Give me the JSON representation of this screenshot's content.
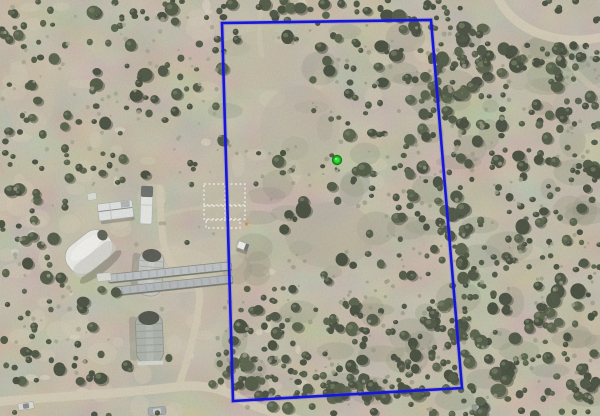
{
  "scene": {
    "kind": "aerial-parcel-map",
    "description": "Aerial drone photo of a rural scrubland property with a blue parcel boundary overlay and a green location marker; farm buildings and dirt roads at left",
    "width": 600,
    "height": 416
  },
  "palette": {
    "base": "#b5ab97",
    "dirt_light": "#cfc6b0",
    "dirt_bright": "#ded6c2",
    "scrub_gray": "#82846e",
    "speck_olive": "#8d8f78",
    "speck_tan": "#97987f",
    "tree_shadow": "#20251a",
    "tree_highlight": "#5d684a",
    "road": "#d2c8b2",
    "trail": "#c9b88f"
  },
  "vegetation": {
    "tree_palette": [
      "#2d3626",
      "#37422c",
      "#404c33",
      "#2a3322",
      "#333d2a"
    ],
    "regions": [
      {
        "name": "left-far",
        "x": 0,
        "y": 0,
        "w": 70,
        "h": 416,
        "count": 95
      },
      {
        "name": "left-mid",
        "x": 70,
        "y": 0,
        "w": 150,
        "h": 416,
        "count": 115
      },
      {
        "name": "top-strip",
        "x": 90,
        "y": 0,
        "w": 370,
        "h": 22,
        "count": 42
      },
      {
        "name": "inside-parcel",
        "x": 215,
        "y": 15,
        "w": 250,
        "h": 385,
        "count": 215
      },
      {
        "name": "inside-right",
        "x": 400,
        "y": 20,
        "w": 65,
        "h": 380,
        "count": 85
      },
      {
        "name": "east-dense",
        "x": 460,
        "y": 0,
        "w": 140,
        "h": 416,
        "count": 265
      },
      {
        "name": "top-right",
        "x": 430,
        "y": 0,
        "w": 170,
        "h": 90,
        "count": 62
      },
      {
        "name": "bottom-band",
        "x": 0,
        "y": 358,
        "w": 600,
        "h": 58,
        "count": 95
      },
      {
        "name": "bottom-inside",
        "x": 230,
        "y": 300,
        "w": 230,
        "h": 100,
        "count": 80
      }
    ],
    "clearings": [
      [
        115,
        210,
        48,
        26
      ],
      [
        92,
        252,
        38,
        30
      ],
      [
        150,
        273,
        24,
        30
      ],
      [
        149,
        338,
        24,
        34
      ],
      [
        172,
        278,
        70,
        20
      ],
      [
        226,
        205,
        30,
        27
      ],
      [
        265,
        95,
        48,
        58
      ],
      [
        252,
        250,
        30,
        38
      ],
      [
        120,
        397,
        135,
        16
      ],
      [
        197,
        340,
        20,
        62
      ],
      [
        545,
        28,
        58,
        16
      ],
      [
        332,
        228,
        34,
        26
      ],
      [
        163,
        180,
        14,
        30
      ],
      [
        500,
        12,
        40,
        18
      ],
      [
        40,
        400,
        60,
        12
      ]
    ],
    "specks_inside": {
      "x": 215,
      "y": 20,
      "w": 385,
      "h": 390,
      "count": 320,
      "color": "#8d8f78"
    },
    "specks_left": {
      "x": 0,
      "y": 0,
      "w": 215,
      "h": 416,
      "count": 130,
      "color": "#97987f"
    }
  },
  "terrain": {
    "light_patches": {
      "count": 70,
      "color": "#cfc6b0",
      "opacity": 0.5
    },
    "bright_patches": {
      "count": 25,
      "color": "#ded6c2",
      "opacity": 0.6
    },
    "gray_blotches": {
      "x": 220,
      "y": 30,
      "w": 380,
      "h": 370,
      "count": 80,
      "color": "#82846e",
      "opacity": 0.28
    },
    "soft_shapes": [
      {
        "name": "yard-clearing",
        "e": [
          175,
          270,
          42,
          23
        ],
        "fill": "#cdc3ad",
        "opacity": 0.55
      },
      {
        "name": "yard-clearing-2",
        "e": [
          215,
          255,
          30,
          18
        ],
        "fill": "#c9bfa9",
        "opacity": 0.45
      },
      {
        "name": "yard-clearing-3",
        "e": [
          150,
          300,
          30,
          15
        ],
        "fill": "#c9bfa9",
        "opacity": 0.4
      },
      {
        "name": "open-upper-inside",
        "e": [
          262,
          60,
          36,
          30
        ],
        "fill": "#bdb49f",
        "opacity": 0.6
      },
      {
        "name": "open-mid-inside",
        "e": [
          300,
          130,
          40,
          45
        ],
        "fill": "#b4ad9b",
        "opacity": 0.5
      },
      {
        "name": "gray-open-center",
        "e": [
          330,
          235,
          45,
          33
        ],
        "fill": "#a8a393",
        "opacity": 0.5
      },
      {
        "name": "rocky-top-right",
        "e": [
          583,
          108,
          30,
          26
        ],
        "fill": "#b3ada0",
        "opacity": 0.7
      },
      {
        "name": "rocky-top-right-2",
        "e": [
          520,
          80,
          14,
          10
        ],
        "fill": "#a9a495",
        "opacity": 0.5
      },
      {
        "name": "open-left-edge",
        "e": [
          30,
          95,
          25,
          40
        ],
        "fill": "#c3b9a4",
        "opacity": 0.5
      },
      {
        "name": "grid-soil",
        "e": [
          226,
          205,
          26,
          24
        ],
        "fill": "#c2b9a6",
        "opacity": 0.5
      }
    ]
  },
  "roads": [
    {
      "name": "main-entrance-road",
      "d": "M -5,402 C 60,396 120,394 175,387 C 205,383 225,390 240,399 C 258,409 280,414 300,420",
      "stroke": "#d2c8b2",
      "width": 9,
      "opacity": 0.95
    },
    {
      "name": "driveway-north",
      "d": "M 178,388 C 188,360 196,330 199,305 C 202,288 196,280 185,275 C 172,270 165,255 163,240 C 161,222 160,203 160,188",
      "stroke": "#d0c6b0",
      "width": 7,
      "opacity": 0.9
    },
    {
      "name": "path-to-garden",
      "d": "M 165,215 C 180,210 195,208 212,206",
      "stroke": "#cdc3ae",
      "width": 4,
      "opacity": 0.5
    },
    {
      "name": "top-right-road",
      "d": "M 497,-5 C 505,15 525,32 555,38 C 575,42 590,40 606,36",
      "stroke": "#d4cab4",
      "width": 9,
      "opacity": 0.9
    },
    {
      "name": "top-right-spur",
      "d": "M 555,38 C 565,60 580,80 600,92",
      "stroke": "#ccc2ac",
      "width": 6,
      "opacity": 0.6
    },
    {
      "name": "top-center-path",
      "d": "M 262,-2 C 259,18 258,36 262,55",
      "stroke": "#cdc3ae",
      "width": 5,
      "opacity": 0.5
    },
    {
      "name": "fence-line-trail",
      "d": "M 245,396 C 310,392 400,388 458,386",
      "stroke": "#c9b88f",
      "width": 2.5,
      "opacity": 0.55
    }
  ],
  "structures": [
    {
      "name": "dome-barn",
      "cx": 89,
      "cy": 252,
      "rot": -38,
      "parts": [
        {
          "t": "ellipse",
          "g": [
            0,
            19,
            26,
            6
          ],
          "fill": "#3e3d33",
          "op": 0.35
        },
        {
          "t": "rect",
          "g": [
            -25,
            -16.5,
            50,
            33,
            15
          ],
          "fill": "#eeeeec",
          "stroke": "#a3a39d",
          "sw": 0.8
        },
        {
          "t": "rect",
          "g": [
            -25,
            2,
            50,
            14,
            7
          ],
          "fill": "#c9c9c3",
          "op": 0.7
        },
        {
          "t": "ellipse",
          "g": [
            0,
            -5,
            19,
            7
          ],
          "fill": "#f8f8f6",
          "op": 0.8
        },
        {
          "t": "ellipse",
          "g": [
            21,
            -5,
            5,
            5.5
          ],
          "fill": "#45483f",
          "op": 1
        }
      ]
    },
    {
      "name": "mobile-home",
      "cx": 115.5,
      "cy": 210.5,
      "rot": -7,
      "parts": [
        {
          "t": "rect",
          "g": [
            -16,
            4,
            34,
            8,
            2
          ],
          "fill": "#3e3d33",
          "op": 0.35
        },
        {
          "t": "rect",
          "g": [
            -17.5,
            -8.5,
            35,
            17,
            1
          ],
          "fill": "#e3e5e4",
          "stroke": "#9fa2a3",
          "sw": 0.7
        },
        {
          "t": "line",
          "g": [
            -17,
            -1,
            17,
            -1
          ],
          "stroke": "#787d7f",
          "sw": 1
        },
        {
          "t": "rect",
          "g": [
            6,
            -8,
            9,
            6,
            0
          ],
          "fill": "#9aa0a2",
          "op": 0.8
        },
        {
          "t": "line",
          "g": [
            -5,
            -8.5,
            -5,
            8.5
          ],
          "stroke": "#b8bbba",
          "sw": 0.8
        }
      ]
    },
    {
      "name": "rv-trailer",
      "cx": 146.5,
      "cy": 205,
      "rot": 2,
      "parts": [
        {
          "t": "rect",
          "g": [
            -6,
            -19,
            12,
            38,
            2
          ],
          "fill": "#e9eae8",
          "stroke": "#a9aba8",
          "sw": 0.7
        },
        {
          "t": "rect",
          "g": [
            -6,
            -19,
            12,
            11,
            2
          ],
          "fill": "#565a58",
          "op": 1
        },
        {
          "t": "line",
          "g": [
            -6,
            0,
            6,
            0
          ],
          "stroke": "#c2c4c1",
          "sw": 0.8
        }
      ]
    },
    {
      "name": "small-shed",
      "cx": 92,
      "cy": 196.5,
      "rot": -10,
      "parts": [
        {
          "t": "rect",
          "g": [
            -4.5,
            -3.5,
            9,
            7,
            0.5
          ],
          "fill": "#dcdcd6",
          "stroke": "#a9a9a3",
          "sw": 0.6
        }
      ]
    },
    {
      "name": "quonset-hut-silver",
      "cx": 150.5,
      "cy": 273,
      "rot": 4,
      "parts": [
        {
          "t": "rect",
          "g": [
            -19,
            -19,
            8,
            40,
            3
          ],
          "fill": "#514f44",
          "op": 0.3
        },
        {
          "t": "rect",
          "g": [
            -12.5,
            -23,
            25,
            46,
            11
          ],
          "fill": "#c0c3bf",
          "stroke": "#8f928e",
          "sw": 0.8
        },
        {
          "t": "rect",
          "g": [
            -3,
            -21,
            6,
            42,
            3
          ],
          "fill": "#d4d7d3",
          "op": 0.5
        },
        {
          "t": "line",
          "g": [
            -12,
            -12,
            12,
            -12
          ],
          "stroke": "#a6a9a5",
          "sw": 1
        },
        {
          "t": "line",
          "g": [
            -12,
            -6,
            12,
            -6
          ],
          "stroke": "#a6a9a5",
          "sw": 1
        },
        {
          "t": "line",
          "g": [
            -12,
            0,
            12,
            0
          ],
          "stroke": "#a6a9a5",
          "sw": 1
        },
        {
          "t": "line",
          "g": [
            -12,
            6,
            12,
            6
          ],
          "stroke": "#a6a9a5",
          "sw": 1
        },
        {
          "t": "line",
          "g": [
            -12,
            12,
            12,
            12
          ],
          "stroke": "#a6a9a5",
          "sw": 1
        },
        {
          "t": "ellipse",
          "g": [
            0,
            -17.5,
            9.5,
            6.5
          ],
          "fill": "#3f413c",
          "op": 1
        }
      ]
    },
    {
      "name": "quonset-hut-metal",
      "cx": 149.5,
      "cy": 338,
      "rot": -2,
      "parts": [
        {
          "t": "rect",
          "g": [
            -20,
            -22,
            8,
            44,
            3
          ],
          "fill": "#514f44",
          "op": 0.25
        },
        {
          "t": "rect",
          "g": [
            -13.5,
            -26,
            27,
            52,
            12
          ],
          "fill": "#a4aaa3",
          "stroke": "#7e847d",
          "sw": 0.8
        },
        {
          "t": "rect",
          "g": [
            -3.5,
            -23,
            7,
            47,
            3
          ],
          "fill": "#b6bcb5",
          "op": 0.6
        },
        {
          "t": "line",
          "g": [
            -13,
            -14,
            13,
            -14
          ],
          "stroke": "#8f958e",
          "sw": 1
        },
        {
          "t": "line",
          "g": [
            -13,
            -7,
            13,
            -7
          ],
          "stroke": "#8f958e",
          "sw": 1
        },
        {
          "t": "line",
          "g": [
            -13,
            0,
            13,
            0
          ],
          "stroke": "#8f958e",
          "sw": 1
        },
        {
          "t": "line",
          "g": [
            -13,
            7,
            13,
            7
          ],
          "stroke": "#8f958e",
          "sw": 1
        },
        {
          "t": "line",
          "g": [
            -13,
            14,
            13,
            14
          ],
          "stroke": "#8f958e",
          "sw": 1
        },
        {
          "t": "ellipse",
          "g": [
            0,
            -20,
            10.5,
            7
          ],
          "fill": "#363a31",
          "op": 1
        },
        {
          "t": "rect",
          "g": [
            -13,
            23,
            26,
            4,
            1
          ],
          "fill": "#d3d6d0",
          "op": 1
        }
      ]
    },
    {
      "name": "greenhouse-row-1",
      "cx": 170,
      "cy": 272.5,
      "rot": -6,
      "parts": [
        {
          "t": "rect",
          "g": [
            -62,
            -4.5,
            124,
            9,
            3
          ],
          "fill": "#b9bec3",
          "stroke": "#72766d",
          "sw": 0.7
        },
        {
          "t": "line",
          "g": [
            -62,
            3.8,
            62,
            3.8
          ],
          "stroke": "#5f6359",
          "sw": 1.2
        },
        {
          "t": "line",
          "g": [
            -62,
            0,
            62,
            0
          ],
          "stroke": "#9aa0a6",
          "sw": 7,
          "dash": "2 6",
          "op": 0.5
        }
      ]
    },
    {
      "name": "greenhouse-row-2",
      "cx": 173,
      "cy": 285.5,
      "rot": -6,
      "parts": [
        {
          "t": "rect",
          "g": [
            -60,
            -4.5,
            120,
            9,
            3
          ],
          "fill": "#aeb3b8",
          "stroke": "#72766d",
          "sw": 0.7
        },
        {
          "t": "line",
          "g": [
            -60,
            3.8,
            60,
            3.8
          ],
          "stroke": "#5f6359",
          "sw": 1.2
        },
        {
          "t": "line",
          "g": [
            -60,
            0,
            60,
            0
          ],
          "stroke": "#959ba1",
          "sw": 7,
          "dash": "2 6",
          "op": 0.5
        }
      ]
    },
    {
      "name": "greenhouse-end-cap",
      "cx": 104,
      "cy": 277,
      "rot": -6,
      "parts": [
        {
          "t": "rect",
          "g": [
            -7,
            -4,
            14,
            8,
            1
          ],
          "fill": "#dcdcd6",
          "stroke": "#a3a39d",
          "sw": 0.5
        }
      ]
    },
    {
      "name": "pickup-truck",
      "cx": 243,
      "cy": 246,
      "rot": 20,
      "parts": [
        {
          "t": "rect",
          "g": [
            -5,
            2,
            11,
            5,
            1
          ],
          "fill": "#3a392f",
          "op": 0.4
        },
        {
          "t": "rect",
          "g": [
            -5.5,
            -3.5,
            11,
            7,
            1
          ],
          "fill": "#f4f4f1",
          "stroke": "#9b9b97",
          "sw": 0.5
        },
        {
          "t": "rect",
          "g": [
            2,
            -3.5,
            3.5,
            7,
            0.5
          ],
          "fill": "#5a5e62",
          "op": 1
        }
      ]
    },
    {
      "name": "parked-car-west",
      "cx": 26,
      "cy": 406,
      "rot": -8,
      "parts": [
        {
          "t": "rect",
          "g": [
            -8,
            -3.5,
            16,
            7,
            1.5
          ],
          "fill": "#dadad5",
          "stroke": "#8f8f8a",
          "sw": 0.5
        },
        {
          "t": "rect",
          "g": [
            -3,
            -2.5,
            6,
            5,
            1
          ],
          "fill": "#777b80",
          "op": 1
        }
      ]
    },
    {
      "name": "parked-car-mid",
      "cx": 157,
      "cy": 411,
      "rot": -4,
      "parts": [
        {
          "t": "rect",
          "g": [
            -9,
            -4,
            18,
            8,
            2
          ],
          "fill": "#9ba1a5",
          "stroke": "#7b807f",
          "sw": 0.5
        },
        {
          "t": "rect",
          "g": [
            -4,
            -2.5,
            8,
            5,
            1
          ],
          "fill": "#c9cdcc",
          "op": 1
        }
      ]
    },
    {
      "name": "parked-car-east",
      "cx": 481,
      "cy": 408,
      "rot": -4,
      "parts": [
        {
          "t": "rect",
          "g": [
            -9,
            -4,
            18,
            8,
            2
          ],
          "fill": "#878d8c",
          "stroke": "#6e7372",
          "sw": 0.5
        },
        {
          "t": "rect",
          "g": [
            -4,
            -2.5,
            8,
            5,
            1
          ],
          "fill": "#aeb2b0",
          "op": 1
        }
      ]
    }
  ],
  "garden_grid": {
    "stroke": "#f4f1e8",
    "dash": "2 2.5",
    "stroke_width": 1.4,
    "fill": "rgba(190,182,160,0.25)",
    "cells": [
      [
        204,
        184,
        21,
        21
      ],
      [
        226,
        184,
        19,
        21
      ],
      [
        204,
        206,
        21,
        13
      ],
      [
        226,
        206,
        19,
        13
      ],
      [
        206,
        220,
        34,
        8
      ]
    ],
    "accent_dot": {
      "x": 246.5,
      "y": 224,
      "r": 1.6,
      "color": "#d4831f"
    }
  },
  "boundary": {
    "meaning": "parcel boundary overlay",
    "points": "222,23 431,20 462,388 233,401",
    "color": "#1717d6",
    "glow_color": "#4444ff",
    "stroke_width": 2.6,
    "glow_width": 4.6,
    "glow_opacity": 0.22
  },
  "marker": {
    "meaning": "property location pin",
    "x": 337,
    "y": 160,
    "ring_color": "#0b6e14",
    "mid_color": "#18a51e",
    "core_color": "#35e03a",
    "highlight_color": "#8effa0",
    "shadow_dots": [
      [
        336,
        168.5,
        1.3
      ],
      [
        339,
        170.5,
        1.0
      ]
    ]
  },
  "noise": {
    "mottle_opacity": 0.45,
    "grain_opacity": 0.22,
    "seed": 1337
  }
}
